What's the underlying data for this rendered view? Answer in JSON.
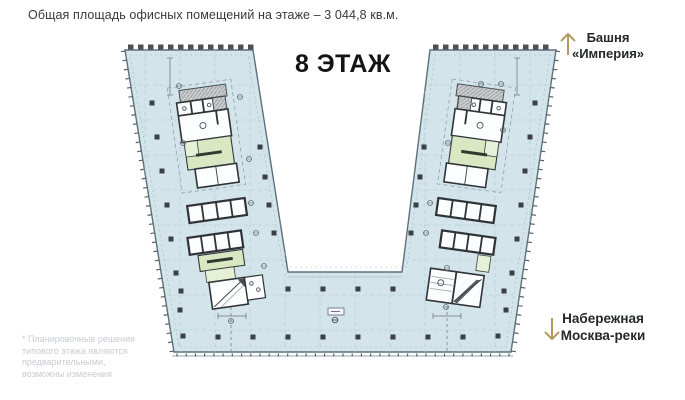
{
  "header": {
    "title": "Общая площадь офисных помещений на этаже – 3 044,8 кв.м."
  },
  "plan": {
    "floor_label": "8 ЭТАЖ",
    "colors": {
      "floor_fill": "#d3e5ea",
      "outline": "#5c707c",
      "core_wall": "#2f3338",
      "room_green": "#d9e8c3",
      "room_green_light": "#e6f0d6",
      "service_gray": "#cdd0d1",
      "accent_arrow": "#b49a5e"
    }
  },
  "annotations": {
    "tower_line1": "Башня",
    "tower_line2": "«Империя»",
    "embankment_line1": "Набережная",
    "embankment_line2": "Москва-реки",
    "footnote": "* Планировочные решения типового этажа являются предварительными, возможны изменения"
  }
}
